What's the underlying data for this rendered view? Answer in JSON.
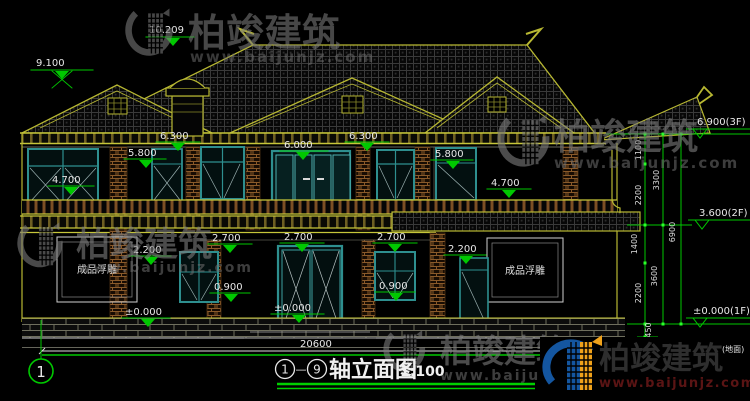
{
  "title": {
    "bubble_start": "1",
    "dash": "—",
    "bubble_end": "9",
    "text": "轴立面图",
    "scale": "1:100"
  },
  "watermark": {
    "brand": "柏竣建筑",
    "url": "www.baijunjz.com"
  },
  "panel_text": "成品浮雕",
  "axis_bubble": "1",
  "bottom_total_dim": "20600",
  "levels": {
    "ridge": "10.209",
    "chimney": "9.100",
    "eave_left": "6.300",
    "eave_right": "6.300",
    "win_head_2f_left": "5.800",
    "win_head_2f_right": "5.800",
    "door_head_2f": "6.000",
    "balcony_left": "4.700",
    "balcony_right": "4.700",
    "win_head_1f_left": "2.700",
    "win_head_1f_center": "2.700",
    "win_head_1f_right": "2.700",
    "panel_top_left": "2.200",
    "panel_top_right": "2.200",
    "sill_left": "0.900",
    "sill_right": "0.900",
    "zero_center": "±0.000",
    "zero_left": "±0.000",
    "floor3": "6.900(3F)",
    "floor2": "3.600(2F)",
    "floor1": "±0.000(1F)",
    "ground_label": "(地面)"
  },
  "vdims": {
    "v1100": "1100",
    "v2200a": "2200",
    "v1400": "1400",
    "v2200b": "2200",
    "v450": "450",
    "v3300": "3300",
    "v3600": "3600",
    "v6900": "6900"
  },
  "colors": {
    "dim_green": "#00c800",
    "cad_yellow": "#b8b832",
    "window_teal": "#2e8f8f",
    "railing_brown": "#7c4f24",
    "text_white": "#e8e8e8",
    "watermark_gray": "#7a7a7a",
    "logo_blue": "#1456a0",
    "logo_orange": "#f0a21b",
    "url_dark_red": "#5a1414"
  }
}
